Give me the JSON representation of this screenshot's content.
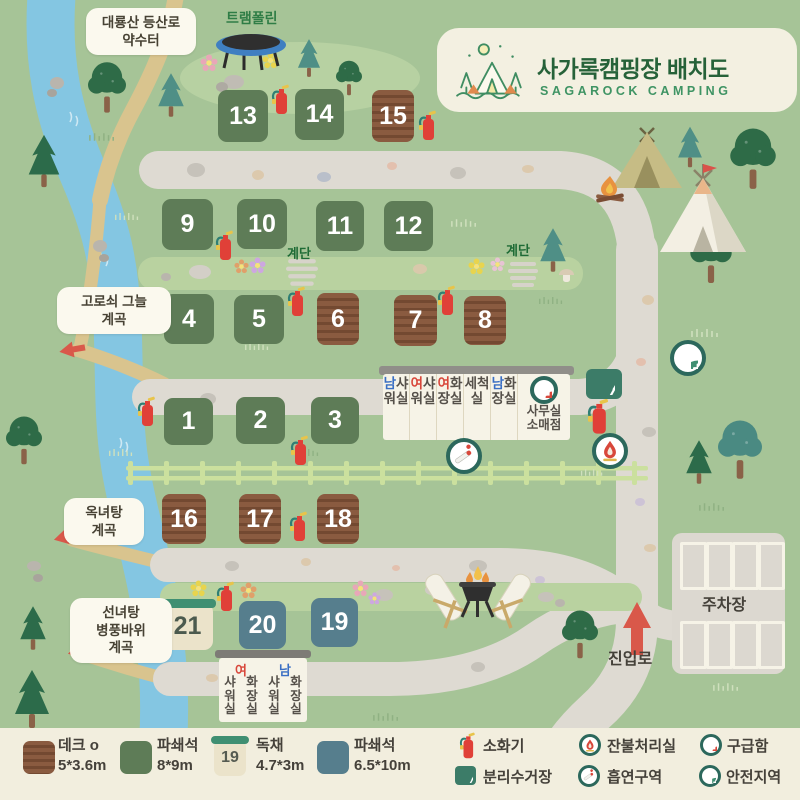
{
  "colors": {
    "background": "#a6c497",
    "road": "#dedad2",
    "river": "#84c6e2",
    "trail": "#d9c48e",
    "site_green": "#5e7c57",
    "site_deck_brown": "#8a5b40",
    "site_blue": "#567e8d",
    "site_cottage": "#ebe3ca",
    "accent_red": "#d8473b",
    "icon_ring_green": "#2c685c",
    "legend_bg": "#f2eede",
    "band_green": "#b9d2a0",
    "fence_green": "#cbe09e"
  },
  "logo": {
    "title": "사가록캠핑장 배치도",
    "subtitle": "SAGAROCK CAMPING"
  },
  "labels": {
    "trailhead_line1": "대룡산 등산로",
    "trailhead_line2": "약수터",
    "trampoline": "트램폴린",
    "stairs": "계단",
    "valley1_line1": "고로쇠 그늘",
    "valley1_line2": "계곡",
    "valley2_line1": "옥녀탕",
    "valley2_line2": "계곡",
    "valley3_line1": "선녀탕",
    "valley3_line2": "병풍바위",
    "valley3_line3": "계곡",
    "parking": "주차장",
    "entrance": "진입로"
  },
  "sites": [
    {
      "num": "1",
      "type": "gravel-green"
    },
    {
      "num": "2",
      "type": "gravel-green"
    },
    {
      "num": "3",
      "type": "gravel-green"
    },
    {
      "num": "4",
      "type": "gravel-green"
    },
    {
      "num": "5",
      "type": "gravel-green"
    },
    {
      "num": "6",
      "type": "deck"
    },
    {
      "num": "7",
      "type": "deck"
    },
    {
      "num": "8",
      "type": "deck"
    },
    {
      "num": "9",
      "type": "gravel-green"
    },
    {
      "num": "10",
      "type": "gravel-green"
    },
    {
      "num": "11",
      "type": "gravel-green"
    },
    {
      "num": "12",
      "type": "gravel-green"
    },
    {
      "num": "13",
      "type": "gravel-green"
    },
    {
      "num": "14",
      "type": "gravel-green"
    },
    {
      "num": "15",
      "type": "deck"
    },
    {
      "num": "16",
      "type": "deck"
    },
    {
      "num": "17",
      "type": "deck"
    },
    {
      "num": "18",
      "type": "deck"
    },
    {
      "num": "19",
      "type": "gravel-blue"
    },
    {
      "num": "20",
      "type": "gravel-blue"
    },
    {
      "num": "21",
      "type": "cottage"
    }
  ],
  "building_main": {
    "cols": [
      {
        "head": "남",
        "body": "샤워실",
        "head_color": "blue"
      },
      {
        "head": "여",
        "body": "샤워실",
        "head_color": "red"
      },
      {
        "head": "여",
        "body": "화장실",
        "head_color": "red"
      },
      {
        "head": "",
        "body": "세척실",
        "head_color": "none"
      },
      {
        "head": "남",
        "body": "화장실",
        "head_color": "blue"
      }
    ],
    "office": {
      "line1": "사무실",
      "line2": "소매점"
    }
  },
  "building_lower": {
    "groups": [
      {
        "head": "여",
        "head_color": "red",
        "cols": [
          "샤워실",
          "화장실"
        ]
      },
      {
        "head": "남",
        "head_color": "blue",
        "cols": [
          "샤워실",
          "화장실"
        ]
      }
    ]
  },
  "legend": {
    "site_types": [
      {
        "label": "데크 o",
        "size": "5*3.6m"
      },
      {
        "label": "파쇄석",
        "size": "8*9m"
      },
      {
        "label": "독채",
        "size": "4.7*3m",
        "swatch_num": "19"
      },
      {
        "label": "파쇄석",
        "size": "6.5*10m"
      }
    ],
    "facilities": [
      {
        "icon": "fire-extinguisher-icon",
        "label": "소화기"
      },
      {
        "icon": "recycle-icon",
        "label": "분리수거장"
      },
      {
        "icon": "ember-disposal-icon",
        "label": "잔불처리실"
      },
      {
        "icon": "smoking-area-icon",
        "label": "흡연구역"
      },
      {
        "icon": "first-aid-icon",
        "label": "구급함"
      },
      {
        "icon": "safety-zone-icon",
        "label": "안전지역"
      }
    ]
  }
}
